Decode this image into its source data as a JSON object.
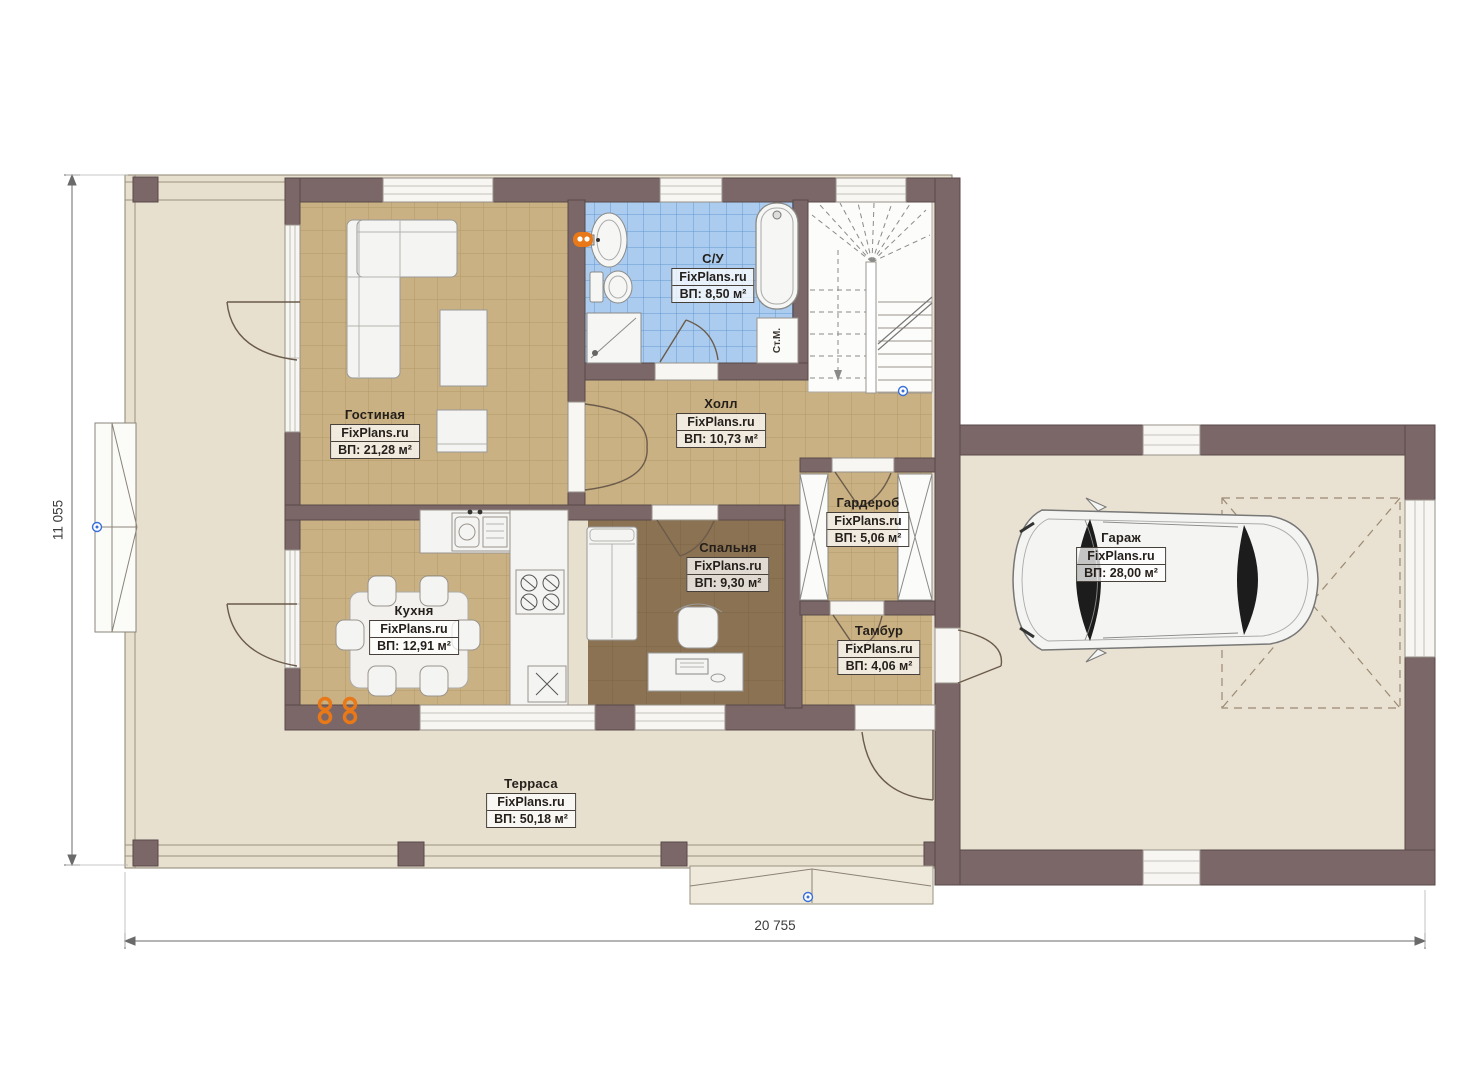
{
  "brand": "FixPlans.ru",
  "rooms": [
    {
      "id": "living",
      "name": "Гостиная",
      "brand": "FixPlans.ru",
      "area": "ВП: 21,28 м²"
    },
    {
      "id": "bath",
      "name": "С/У",
      "brand": "FixPlans.ru",
      "area": "ВП: 8,50 м²"
    },
    {
      "id": "hall",
      "name": "Холл",
      "brand": "FixPlans.ru",
      "area": "ВП: 10,73 м²"
    },
    {
      "id": "kitchen",
      "name": "Кухня",
      "brand": "FixPlans.ru",
      "area": "ВП: 12,91 м²"
    },
    {
      "id": "bedroom",
      "name": "Спальня",
      "brand": "FixPlans.ru",
      "area": "ВП: 9,30 м²"
    },
    {
      "id": "wardrobe",
      "name": "Гардероб",
      "brand": "FixPlans.ru",
      "area": "ВП: 5,06 м²"
    },
    {
      "id": "tambour",
      "name": "Тамбур",
      "brand": "FixPlans.ru",
      "area": "ВП: 4,06 м²"
    },
    {
      "id": "garage",
      "name": "Гараж",
      "brand": "FixPlans.ru",
      "area": "ВП: 28,00 м²"
    },
    {
      "id": "terrace",
      "name": "Терраса",
      "brand": "FixPlans.ru",
      "area": "ВП: 50,18 м²"
    }
  ],
  "annotations": {
    "washing_machine": "Ст.М."
  },
  "dimensions": {
    "width_label": "20 755",
    "height_label": "11 055"
  },
  "colors": {
    "wall": "#7b6767",
    "tile_tan": "#c9b183",
    "tile_blue": "#abccee",
    "bedroom_floor": "#8b7252",
    "terrace_floor": "#e8e0cf",
    "radiator_orange": "#e87818",
    "marker_blue": "#3a6fd8"
  }
}
